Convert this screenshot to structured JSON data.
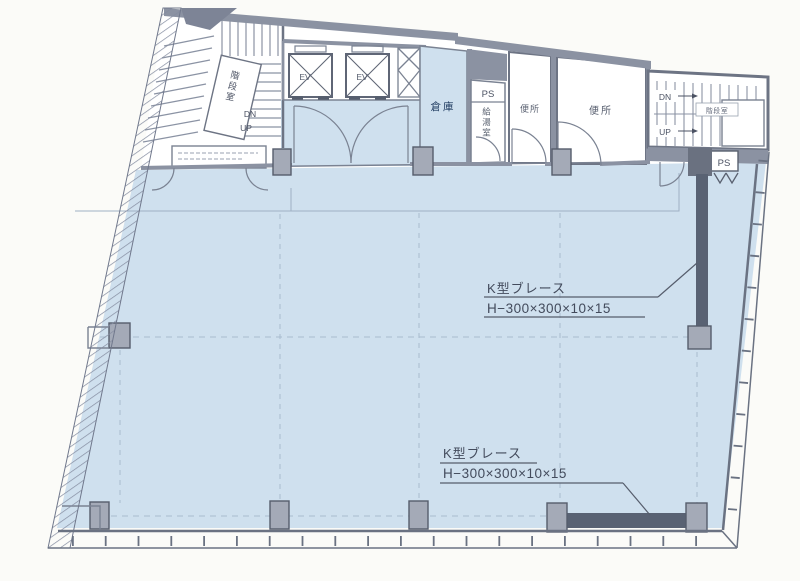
{
  "plan": {
    "labels": {
      "storage": "倉庫",
      "ps_core": "PS",
      "kitchenette": "給湯室",
      "toilet_1": "便所",
      "toilet_2": "便所",
      "ps_right": "PS",
      "ev_1": "EV",
      "ev_2": "EV",
      "stair_left_name": "階段室",
      "stair_right_name": "階段室",
      "stair_left_dn": "DN",
      "stair_left_up": "UP",
      "stair_right_dn": "DN",
      "stair_right_up": "UP"
    },
    "annotations": {
      "brace_upper": {
        "line1": "K型ブレース",
        "line2": "H−300×300×10×15"
      },
      "brace_lower": {
        "line1": "K型ブレース",
        "line2": "H−300×300×10×15"
      }
    },
    "colors": {
      "floor": "#cfe0ee",
      "wall": "#8b92a2",
      "wall_dark": "#6d7484",
      "brace": "#596273",
      "column_fill": "#a4aab7",
      "line": "#7a8292",
      "text": "#434b5c",
      "storage_text": "#1e3a5f"
    }
  }
}
